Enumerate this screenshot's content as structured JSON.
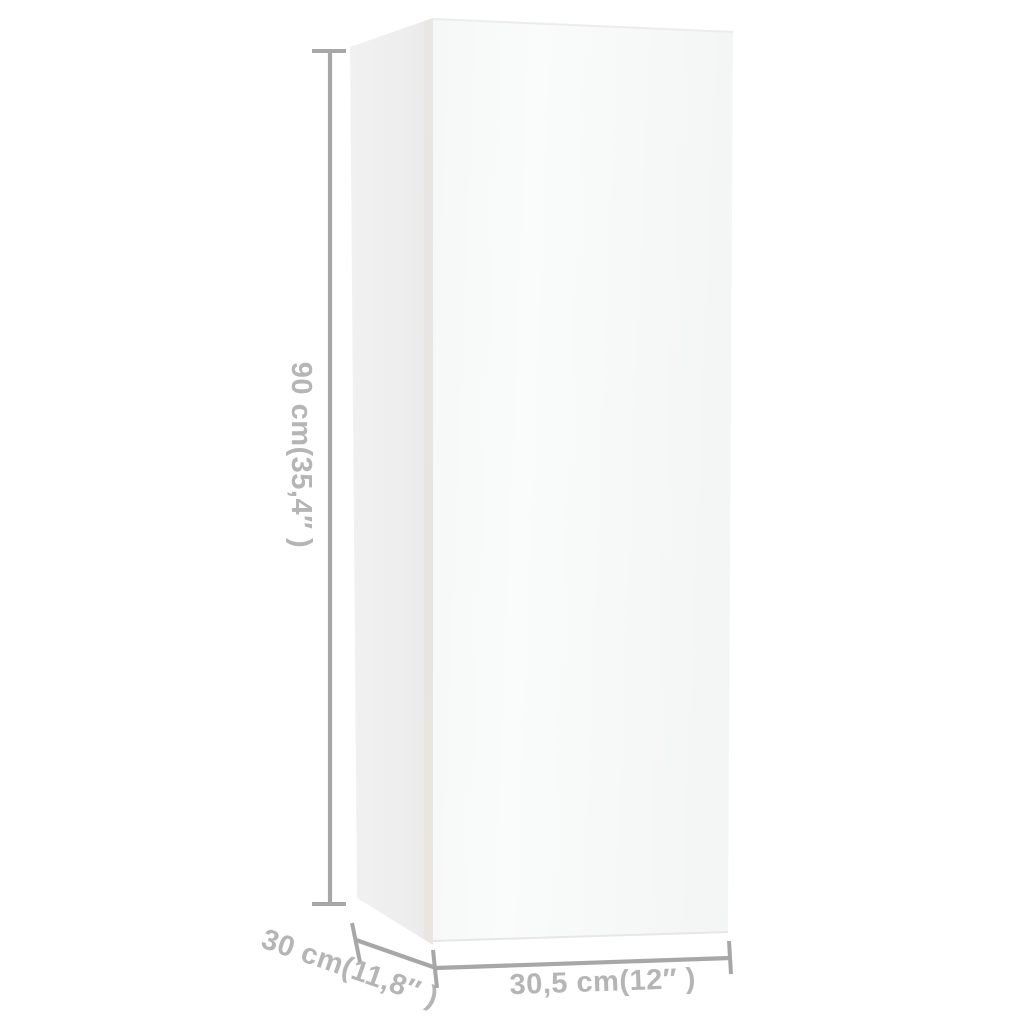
{
  "diagram": {
    "labels": {
      "height": "90 cm(35,4″ )",
      "depth": "30 cm(11,8″ )",
      "width": "30,5 cm(12″ )"
    },
    "colors": {
      "background": "#ffffff",
      "dimension_line": "#a7a7a7",
      "dimension_text": "#b5b5b5",
      "cabinet_front_face": "#f8f9f9",
      "cabinet_side_face": "#ededed",
      "cabinet_edge_strip": "#e8e5e0"
    }
  }
}
